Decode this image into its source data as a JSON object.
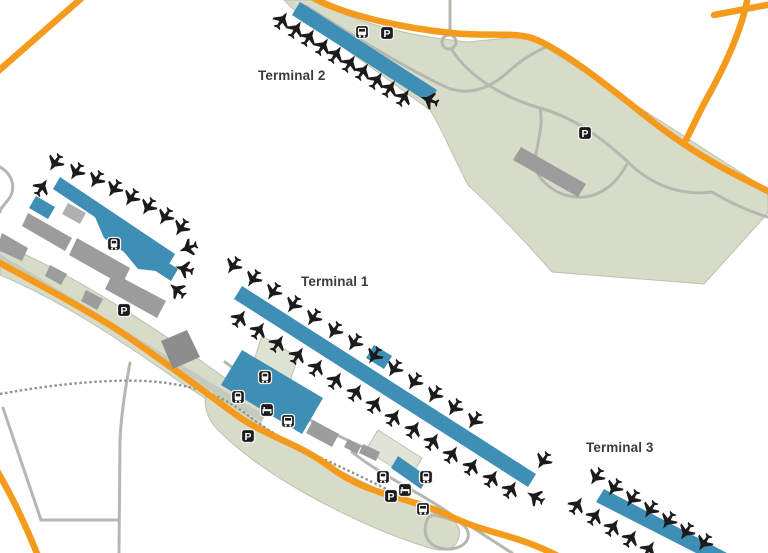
{
  "map": {
    "parking_label": "P",
    "labels": [
      {
        "id": "terminal-2",
        "text": "Terminal 2",
        "x": 258,
        "y": 68
      },
      {
        "id": "terminal-1",
        "text": "Terminal 1",
        "x": 301,
        "y": 274
      },
      {
        "id": "terminal-3",
        "text": "Terminal 3",
        "x": 586,
        "y": 440
      }
    ],
    "icons": [
      {
        "type": "bus",
        "x": 362,
        "y": 32
      },
      {
        "type": "parking",
        "x": 387,
        "y": 33
      },
      {
        "type": "parking",
        "x": 585,
        "y": 133
      },
      {
        "type": "train",
        "x": 114,
        "y": 244
      },
      {
        "type": "parking",
        "x": 124,
        "y": 310
      },
      {
        "type": "train",
        "x": 265,
        "y": 377
      },
      {
        "type": "train",
        "x": 238,
        "y": 397
      },
      {
        "type": "hotel",
        "x": 267,
        "y": 410
      },
      {
        "type": "bus",
        "x": 288,
        "y": 421
      },
      {
        "type": "parking",
        "x": 248,
        "y": 436
      },
      {
        "type": "train",
        "x": 383,
        "y": 477
      },
      {
        "type": "train",
        "x": 426,
        "y": 477
      },
      {
        "type": "hotel",
        "x": 405,
        "y": 490
      },
      {
        "type": "parking",
        "x": 391,
        "y": 496
      },
      {
        "type": "bus",
        "x": 423,
        "y": 509
      }
    ],
    "planes": [
      [
        282,
        20,
        33
      ],
      [
        296,
        29,
        33
      ],
      [
        309,
        37,
        33
      ],
      [
        323,
        46,
        33
      ],
      [
        336,
        54,
        33
      ],
      [
        350,
        63,
        33
      ],
      [
        363,
        71,
        33
      ],
      [
        377,
        80,
        33
      ],
      [
        390,
        88,
        33
      ],
      [
        404,
        97,
        33
      ],
      [
        429,
        100,
        290
      ],
      [
        233,
        266,
        213
      ],
      [
        253,
        279,
        213
      ],
      [
        273,
        292,
        213
      ],
      [
        293,
        305,
        213
      ],
      [
        313,
        318,
        213
      ],
      [
        334,
        331,
        213
      ],
      [
        354,
        343,
        213
      ],
      [
        374,
        356,
        213
      ],
      [
        394,
        369,
        213
      ],
      [
        414,
        382,
        213
      ],
      [
        434,
        395,
        213
      ],
      [
        454,
        408,
        213
      ],
      [
        474,
        421,
        213
      ],
      [
        240,
        318,
        33
      ],
      [
        259,
        330,
        33
      ],
      [
        278,
        343,
        33
      ],
      [
        298,
        355,
        33
      ],
      [
        317,
        367,
        33
      ],
      [
        336,
        380,
        33
      ],
      [
        356,
        392,
        33
      ],
      [
        375,
        404,
        33
      ],
      [
        394,
        417,
        33
      ],
      [
        414,
        429,
        33
      ],
      [
        433,
        441,
        33
      ],
      [
        452,
        454,
        33
      ],
      [
        472,
        466,
        33
      ],
      [
        492,
        478,
        33
      ],
      [
        511,
        489,
        33
      ],
      [
        535,
        497,
        300
      ],
      [
        55,
        163,
        213
      ],
      [
        76,
        172,
        213
      ],
      [
        96,
        180,
        213
      ],
      [
        114,
        189,
        213
      ],
      [
        131,
        198,
        213
      ],
      [
        148,
        207,
        213
      ],
      [
        165,
        217,
        213
      ],
      [
        181,
        228,
        213
      ],
      [
        188,
        248,
        250
      ],
      [
        184,
        269,
        285
      ],
      [
        177,
        290,
        310
      ],
      [
        42,
        187,
        33
      ],
      [
        543,
        461,
        213
      ],
      [
        596,
        477,
        213
      ],
      [
        614,
        488,
        213
      ],
      [
        632,
        499,
        213
      ],
      [
        650,
        510,
        213
      ],
      [
        668,
        521,
        213
      ],
      [
        686,
        532,
        213
      ],
      [
        704,
        543,
        213
      ],
      [
        577,
        505,
        33
      ],
      [
        595,
        516,
        33
      ],
      [
        613,
        527,
        33
      ],
      [
        631,
        538,
        33
      ],
      [
        649,
        549,
        33
      ]
    ],
    "colors": {
      "pier_blue": "#3E8EB6",
      "road_orange": "#F49B1E",
      "area_green": "#D6DCC8",
      "building_gray": "#9C9C9C",
      "road_gray": "#B5B8B1",
      "railway_gray": "#8E948E",
      "icon_black": "#1C1C1C",
      "label_text": "#3C3C3C"
    }
  }
}
